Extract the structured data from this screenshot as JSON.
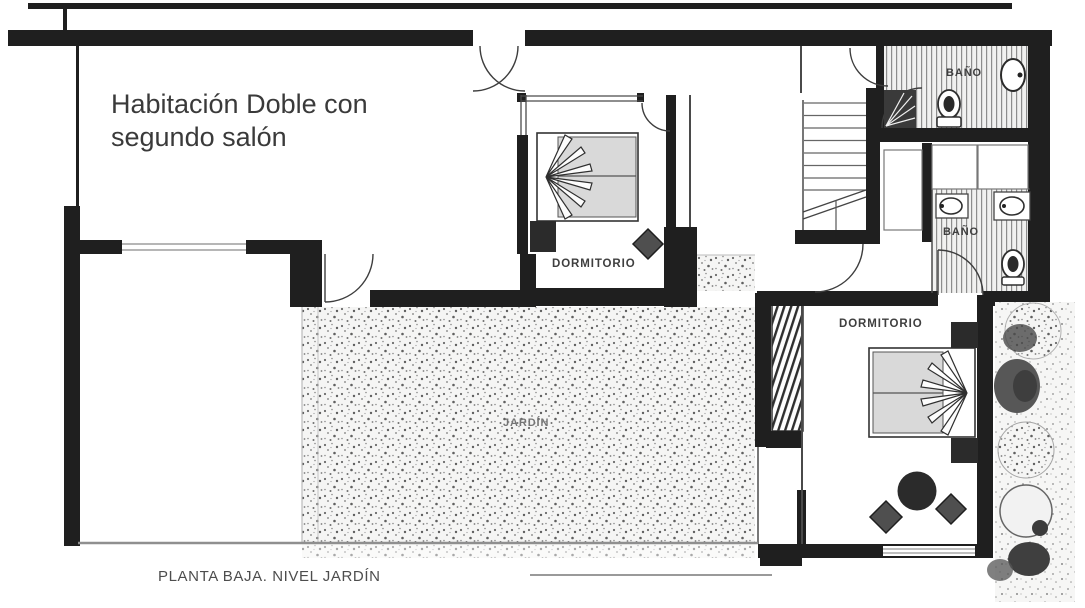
{
  "plan": {
    "annotation": "Habitación Doble con segundo salón",
    "caption": "PLANTA BAJA. NIVEL JARDÍN",
    "rooms": {
      "bedroom_upper": "DORMITORIO",
      "bedroom_right": "DORMITORIO",
      "bathroom_upper": "BAÑO",
      "bathroom_lower": "BAÑO",
      "garden": "JARDÍN"
    },
    "colors": {
      "wall": "#1f1f1f",
      "annotation_text": "#3a3a3a",
      "room_label_text": "#3f3f3f",
      "garden_label_text": "#757575",
      "caption_text": "#4d4d4d",
      "mattress_fill": "#d9d9d9",
      "dark_furniture": "#2b2b2b",
      "chair_fill": "#4f4f4f",
      "paper": "#ffffff"
    }
  }
}
